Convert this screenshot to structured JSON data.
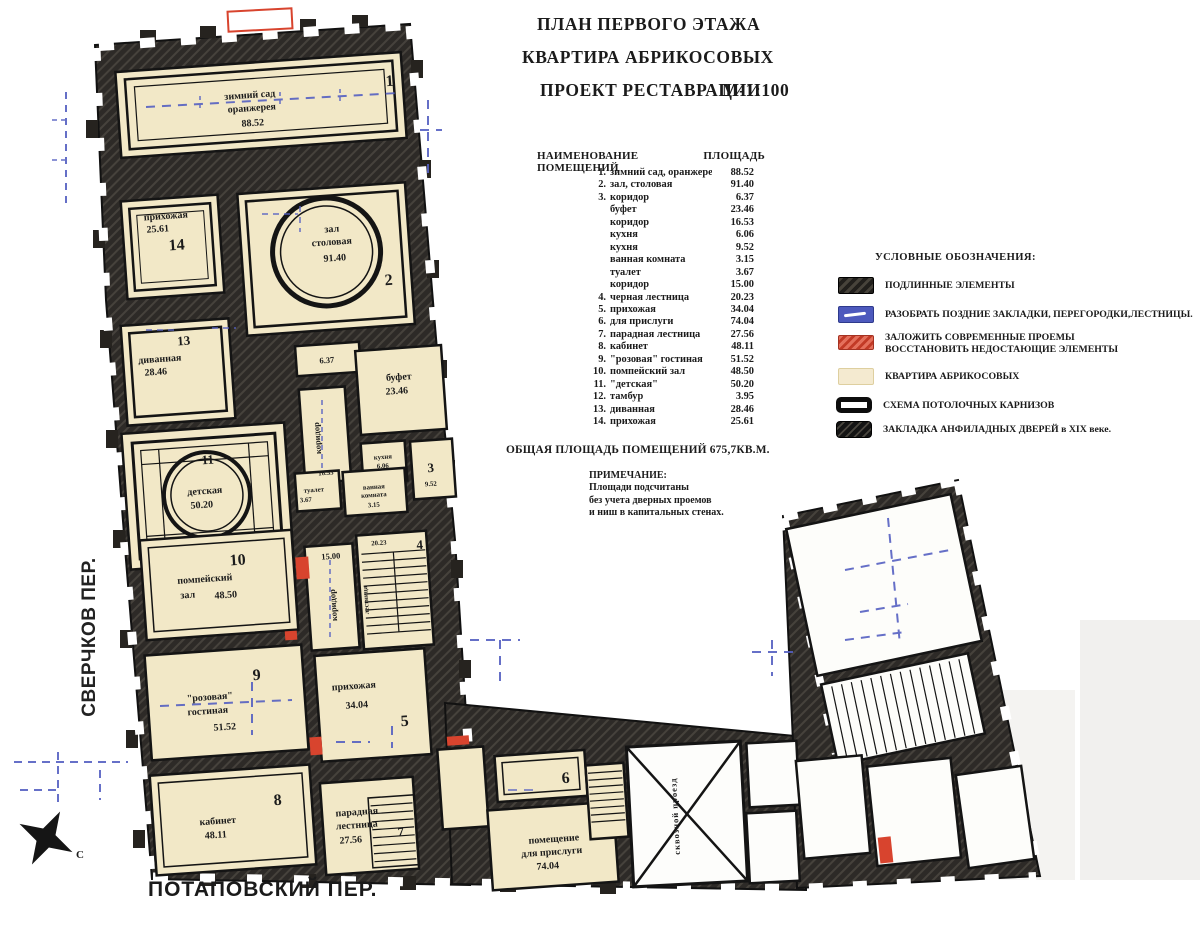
{
  "colors": {
    "wall": "#2d2a27",
    "room_fill": "#f2e8c7",
    "annex_fill": "#fdfdfa",
    "blue": "#5560c2",
    "red": "#d8442e",
    "text": "#1b1b1b"
  },
  "title": {
    "line1": "ПЛАН ПЕРВОГО ЭТАЖА",
    "line2": "КВАРТИРА АБРИКОСОВЫХ",
    "line3": "ПРОЕКТ РЕСТАВРАЦИИ",
    "scale": "М-1:100"
  },
  "room_list": {
    "header_name": "НАИМЕНОВАНИЕ ПОМЕЩЕНИЙ",
    "header_area": "ПЛОЩАДЬ",
    "rows": [
      {
        "num": "1.",
        "name": "зимний сад, оранжерея",
        "area": "88.52"
      },
      {
        "num": "2.",
        "name": "зал, столовая",
        "area": "91.40"
      },
      {
        "num": "3.",
        "name": "коридор",
        "area": "6.37"
      },
      {
        "num": "",
        "name": "буфет",
        "area": "23.46"
      },
      {
        "num": "",
        "name": "коридор",
        "area": "16.53"
      },
      {
        "num": "",
        "name": "кухня",
        "area": "6.06"
      },
      {
        "num": "",
        "name": "кухня",
        "area": "9.52"
      },
      {
        "num": "",
        "name": "ванная комната",
        "area": "3.15"
      },
      {
        "num": "",
        "name": "туалет",
        "area": "3.67"
      },
      {
        "num": "",
        "name": "коридор",
        "area": "15.00"
      },
      {
        "num": "4.",
        "name": "черная лестница",
        "area": "20.23"
      },
      {
        "num": "5.",
        "name": "прихожая",
        "area": "34.04"
      },
      {
        "num": "6.",
        "name": "для прислуги",
        "area": "74.04"
      },
      {
        "num": "7.",
        "name": "парадная лестница",
        "area": "27.56"
      },
      {
        "num": "8.",
        "name": "кабинет",
        "area": "48.11"
      },
      {
        "num": "9.",
        "name": "\"розовая\" гостиная",
        "area": "51.52"
      },
      {
        "num": "10.",
        "name": "помпейский зал",
        "area": "48.50"
      },
      {
        "num": "11.",
        "name": "\"детская\"",
        "area": "50.20"
      },
      {
        "num": "12.",
        "name": "тамбур",
        "area": "3.95"
      },
      {
        "num": "13.",
        "name": "диванная",
        "area": "28.46"
      },
      {
        "num": "14.",
        "name": "прихожая",
        "area": "25.61"
      }
    ],
    "total": "ОБЩАЯ ПЛОЩАДЬ ПОМЕЩЕНИЙ 675,7КВ.М.",
    "note_title": "ПРИМЕЧАНИЕ:",
    "note_lines": [
      "Площади подсчитаны",
      "без учета дверных проемов",
      "и ниш в капитальных стенах."
    ]
  },
  "legend": {
    "header": "УСЛОВНЫЕ ОБОЗНАЧЕНИЯ:",
    "items": [
      {
        "swatch": "original",
        "label": "ПОДЛИННЫЕ ЭЛЕМЕНТЫ"
      },
      {
        "swatch": "dismantle",
        "label": "РАЗОБРАТЬ ПОЗДНИЕ ЗАКЛАДКИ, ПЕРЕГОРОДКИ,ЛЕСТНИЦЫ."
      },
      {
        "swatch": "restore",
        "label": "ЗАЛОЖИТЬ СОВРЕМЕННЫЕ ПРОЕМЫ",
        "label2": "ВОССТАНОВИТЬ НЕДОСТАЮЩИЕ ЭЛЕМЕНТЫ"
      },
      {
        "swatch": "apartment",
        "label": "КВАРТИРА АБРИКОСОВЫХ"
      },
      {
        "swatch": "cornice",
        "label": "СХЕМА ПОТОЛОЧНЫХ КАРНИЗОВ"
      },
      {
        "swatch": "infill",
        "label": "ЗАКЛАДКА АНФИЛАДНЫХ ДВЕРЕЙ в XIX веке."
      }
    ]
  },
  "streets": {
    "left": "СВЕРЧКОВ ПЕР.",
    "bottom": "ПОТАПОВСКИЙ ПЕР."
  },
  "compass": {
    "north": "С"
  },
  "plan": {
    "r1": {
      "num": "1",
      "l1": "зимний сад",
      "l2": "оранжерея",
      "area": "88.52"
    },
    "r2": {
      "num": "2",
      "l1": "зал",
      "l2": "столовая",
      "area": "91.40"
    },
    "r3": {
      "num": "3",
      "area": "9.52"
    },
    "r4": {
      "num": "4",
      "area": "20.23",
      "label": "лестница"
    },
    "r5": {
      "num": "5",
      "l1": "прихожая",
      "area": "34.04"
    },
    "r6": {
      "num": "6"
    },
    "r7": {
      "num": "7",
      "l1": "парадная",
      "l2": "лестница",
      "area": "27.56"
    },
    "r8": {
      "num": "8",
      "l1": "кабинет",
      "area": "48.11"
    },
    "r9": {
      "num": "9",
      "l1": "\"розовая\"",
      "l2": "гостиная",
      "area": "51.52"
    },
    "r10": {
      "num": "10",
      "l1": "помпейский",
      "l2": "зал",
      "area": "48.50"
    },
    "r11": {
      "num": "11",
      "l1": "детская",
      "area": "50.20"
    },
    "r13": {
      "num": "13",
      "l1": "диванная",
      "area": "28.46"
    },
    "r14": {
      "num": "14",
      "l1": "прихожая",
      "area": "25.61"
    },
    "buffet": {
      "l1": "буфет",
      "area": "23.46"
    },
    "corridor_637": {
      "area": "6.37"
    },
    "corridor_1653": {
      "label": "коридор",
      "area": "16.53"
    },
    "kitchen_606": {
      "l1": "кухня",
      "area": "6.06"
    },
    "corridor_1500": {
      "label": "коридор",
      "area": "15.00"
    },
    "bath": {
      "l1": "ванная",
      "l2": "комната",
      "area": "3.15"
    },
    "wc": {
      "l1": "туалет",
      "area": "3.67"
    },
    "servants": {
      "l1": "помещение",
      "l2": "для прислуги",
      "area": "74.04"
    },
    "passage": {
      "label": "сквозной проезд"
    }
  }
}
